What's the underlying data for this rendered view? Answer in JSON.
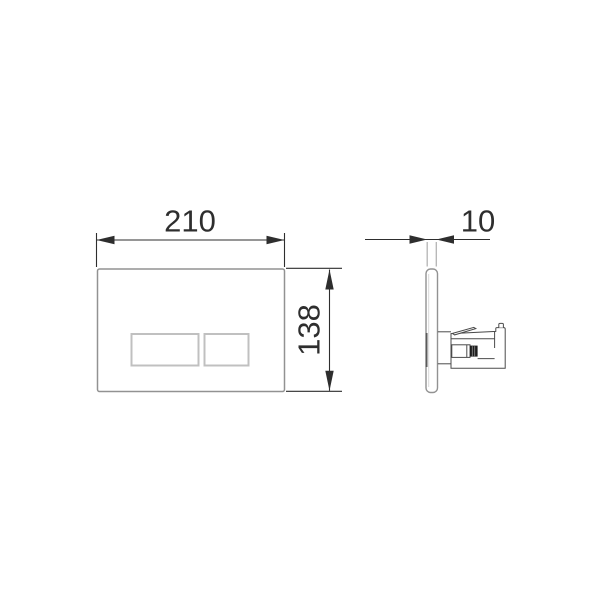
{
  "front_view": {
    "width_dimension": "210",
    "height_dimension": "138"
  },
  "side_view": {
    "depth_dimension": "10"
  },
  "colors": {
    "background": "#ffffff",
    "dimension": "#2e2e2e",
    "plate_outline": "#929292",
    "button_outline": "#c0c0c0",
    "extension_light": "#b4b4b4",
    "mechanism": "#4b4b4b",
    "rod_tip": "#1e1e1e"
  }
}
